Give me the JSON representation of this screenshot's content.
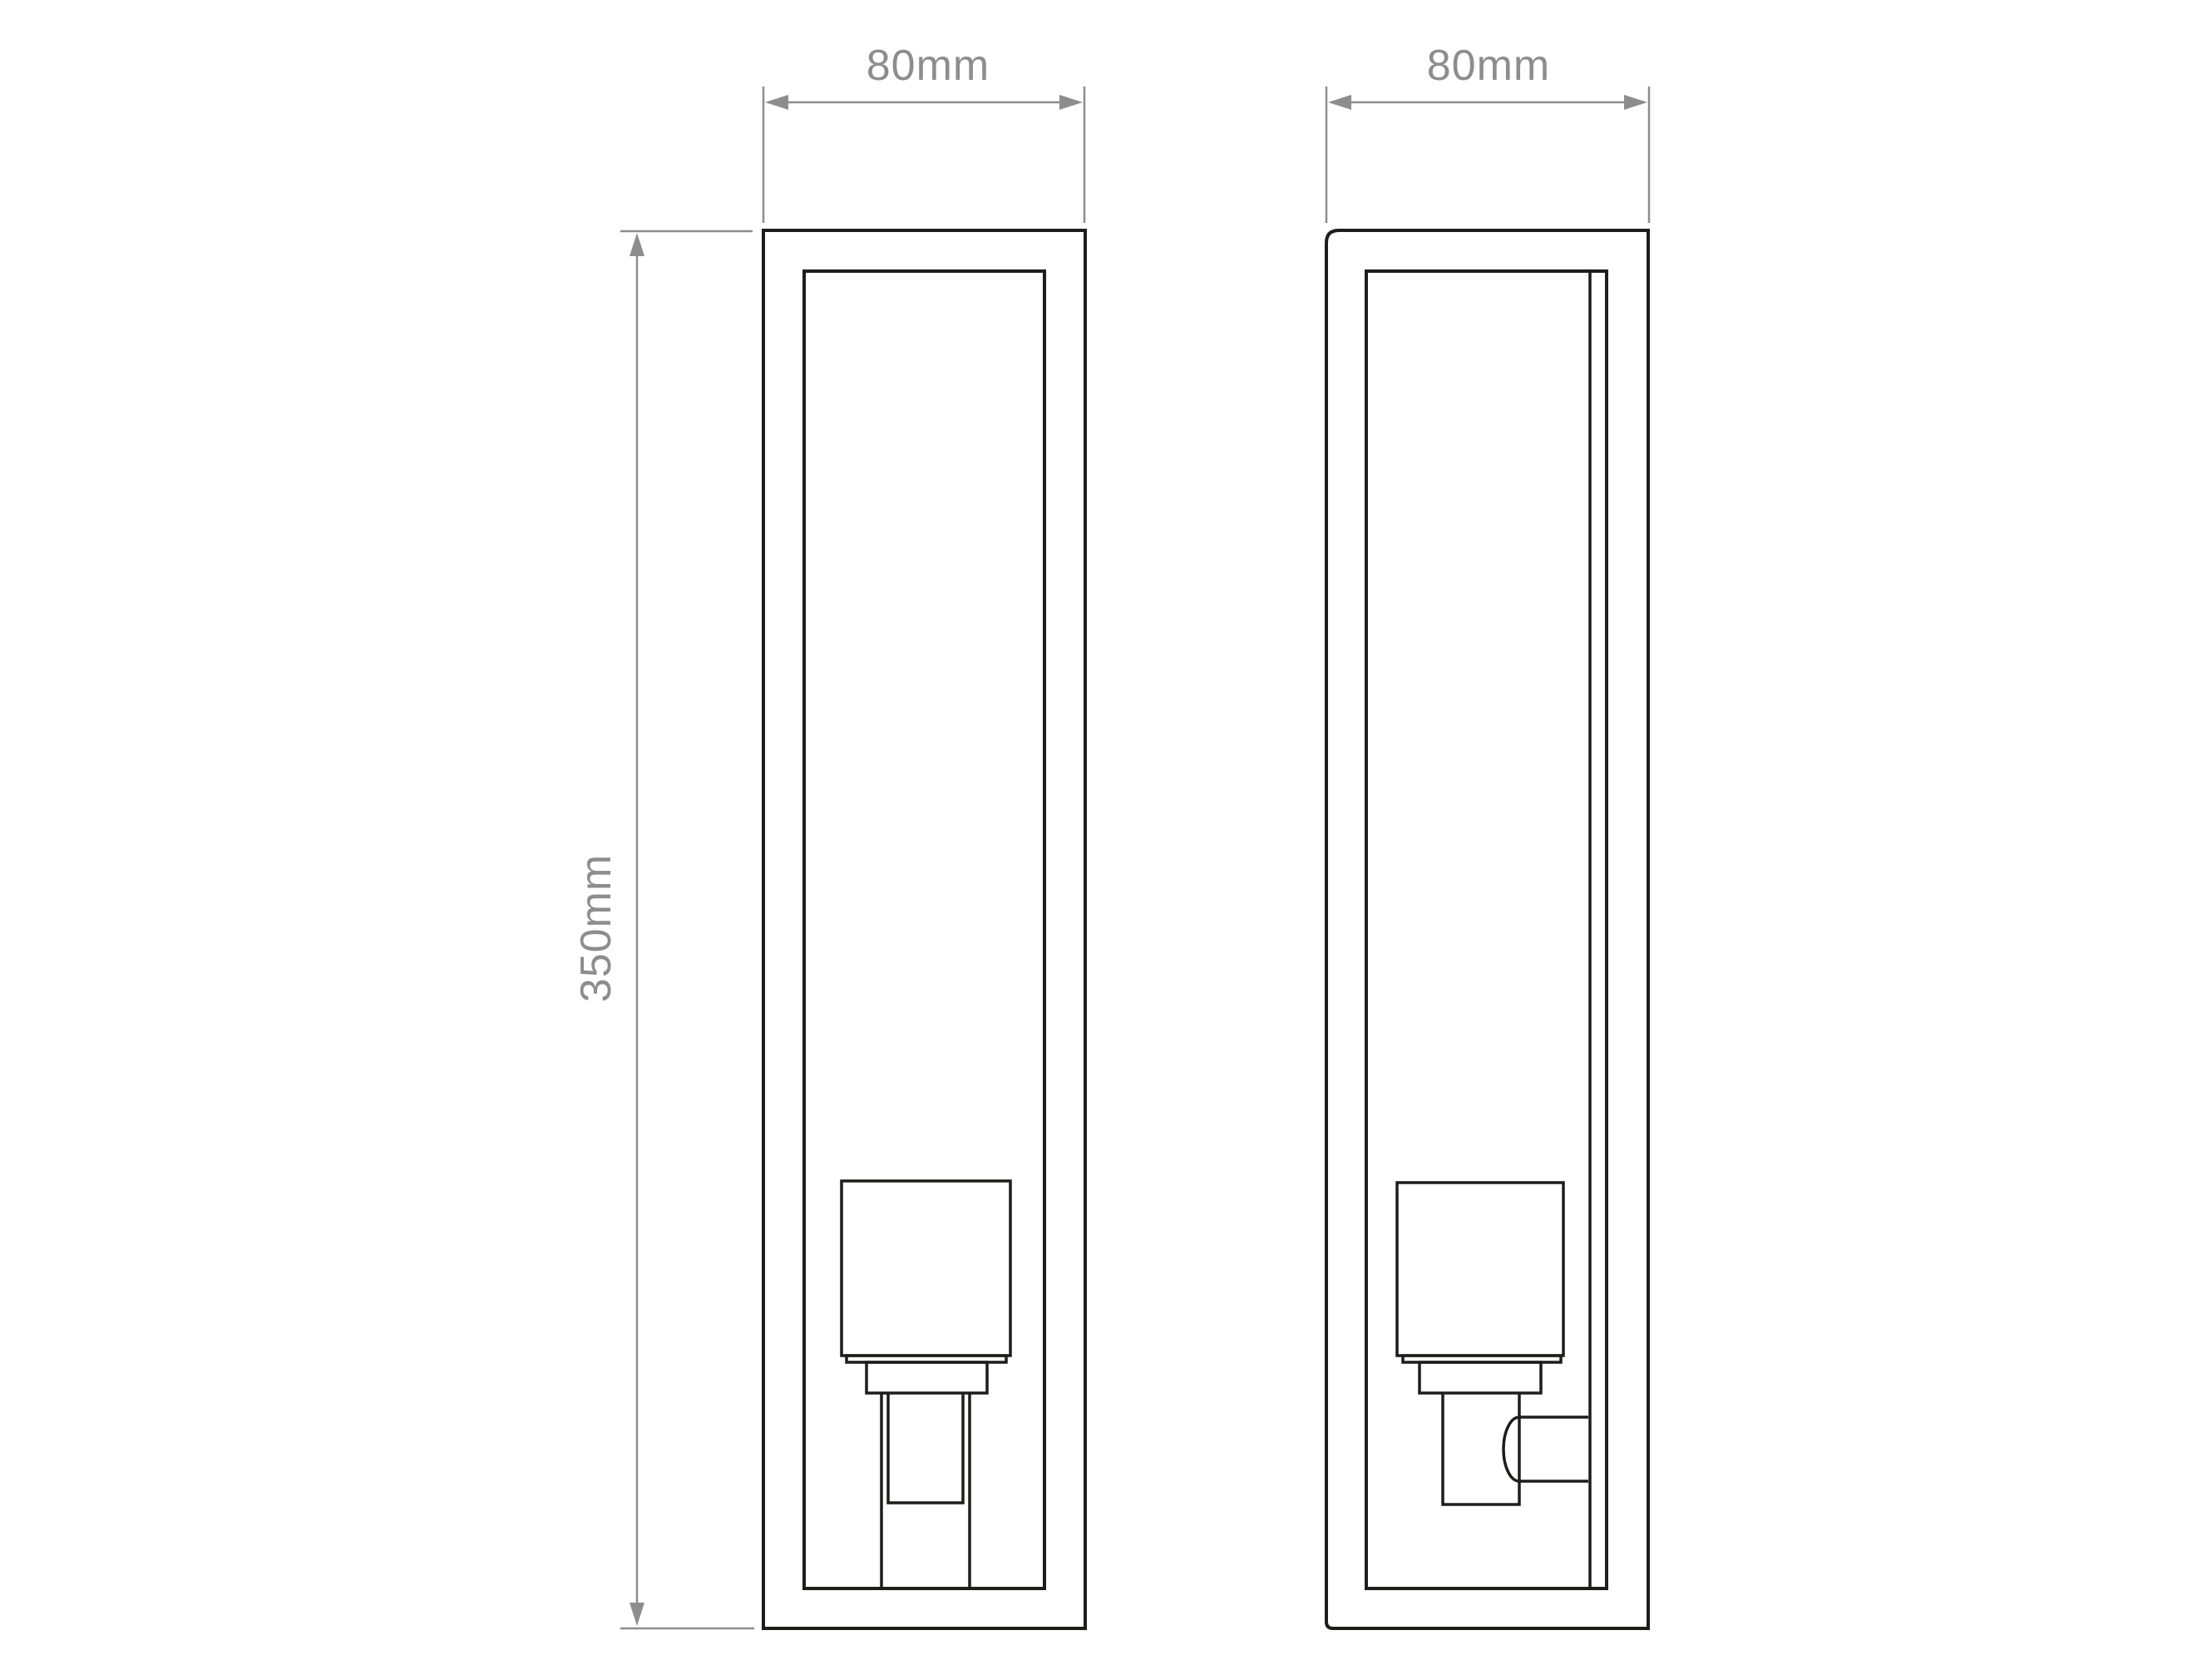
{
  "drawing": {
    "background_color": "#ffffff",
    "ink_color": "#1d1d1b",
    "dimension_color": "#8d8d8d",
    "dimensions": {
      "front_width": "80mm",
      "side_width": "80mm",
      "height": "350mm"
    }
  }
}
